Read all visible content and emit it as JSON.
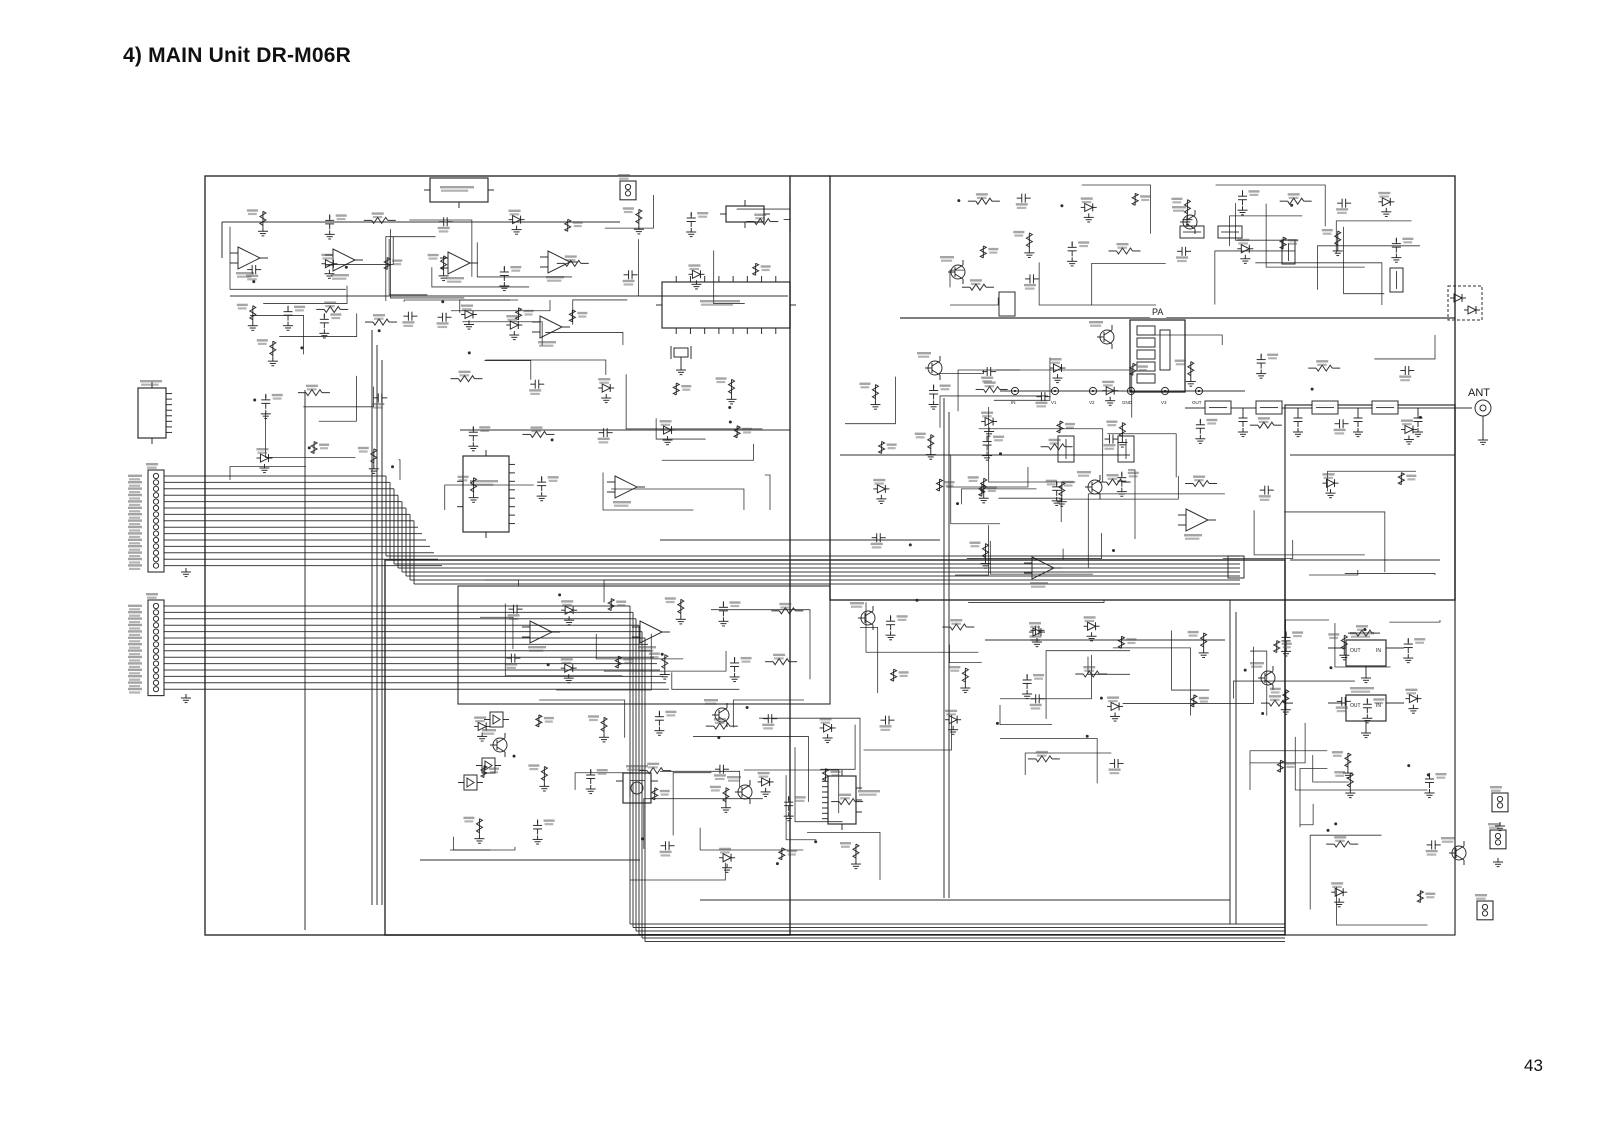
{
  "document": {
    "title": "4) MAIN Unit DR-M06R",
    "page_number": "43"
  },
  "schematic": {
    "ink_color": "#1c1c1c",
    "labels": [
      {
        "id": "ant",
        "text": "ANT",
        "x": 1468,
        "y": 396,
        "size": 11,
        "bg": true
      },
      {
        "id": "pa",
        "text": "PA",
        "x": 1152,
        "y": 315,
        "size": 9,
        "bg": true
      },
      {
        "id": "reg1-out",
        "text": "OUT",
        "x": 1350,
        "y": 652,
        "size": 5,
        "bg": false
      },
      {
        "id": "reg1-in",
        "text": "IN",
        "x": 1376,
        "y": 652,
        "size": 5,
        "bg": false
      },
      {
        "id": "reg2-out",
        "text": "OUT",
        "x": 1350,
        "y": 707,
        "size": 5,
        "bg": false
      },
      {
        "id": "reg2-in",
        "text": "IN",
        "x": 1376,
        "y": 707,
        "size": 5,
        "bg": false
      },
      {
        "id": "tp-in",
        "text": "IN",
        "x": 1011,
        "y": 404,
        "size": 4.5,
        "bg": false
      },
      {
        "id": "tp-v1",
        "text": "V1",
        "x": 1051,
        "y": 404,
        "size": 4.5,
        "bg": false
      },
      {
        "id": "tp-v2",
        "text": "V2",
        "x": 1089,
        "y": 404,
        "size": 4.5,
        "bg": false
      },
      {
        "id": "tp-gnd",
        "text": "GND",
        "x": 1122,
        "y": 404,
        "size": 4.5,
        "bg": false
      },
      {
        "id": "tp-v3",
        "text": "V3",
        "x": 1161,
        "y": 404,
        "size": 4.5,
        "bg": false
      },
      {
        "id": "tp-out",
        "text": "OUT",
        "x": 1192,
        "y": 404,
        "size": 4.5,
        "bg": false
      }
    ]
  }
}
